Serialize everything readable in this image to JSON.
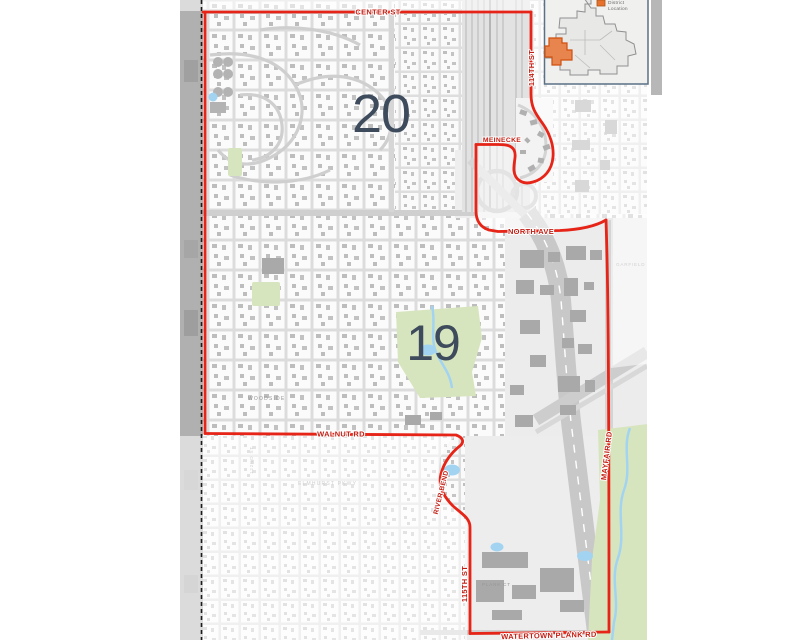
{
  "map": {
    "district_numbers": [
      {
        "label": "20"
      },
      {
        "label": "19"
      }
    ],
    "boundary_street_labels": [
      {
        "name": "CENTER ST"
      },
      {
        "name": "114TH ST"
      },
      {
        "name": "MEINECKE"
      },
      {
        "name": "NORTH AVE"
      },
      {
        "name": "MAYFAIR RD"
      },
      {
        "name": "WALNUT RD"
      },
      {
        "name": "RIVER BEND"
      },
      {
        "name": "115TH ST"
      },
      {
        "name": "WATERTOWN PLANK RD"
      }
    ],
    "base_street_labels": [
      {
        "name": "WOODSIDE"
      },
      {
        "name": "ELMHURST PKWY"
      },
      {
        "name": "122ND ST"
      },
      {
        "name": "GARFIELD AVE"
      },
      {
        "name": "PLANK CT"
      }
    ],
    "colors": {
      "boundary": "#E62417",
      "street_label": "#C21D12",
      "district_number": "#3D4B5C",
      "park": "#D7E5BE",
      "water": "#A2D4F2"
    }
  },
  "inset": {
    "legend": {
      "line1": "District",
      "line2": "Location"
    },
    "highlight_color": "#E8854F",
    "legend_swatch_color": "#E8722C"
  }
}
